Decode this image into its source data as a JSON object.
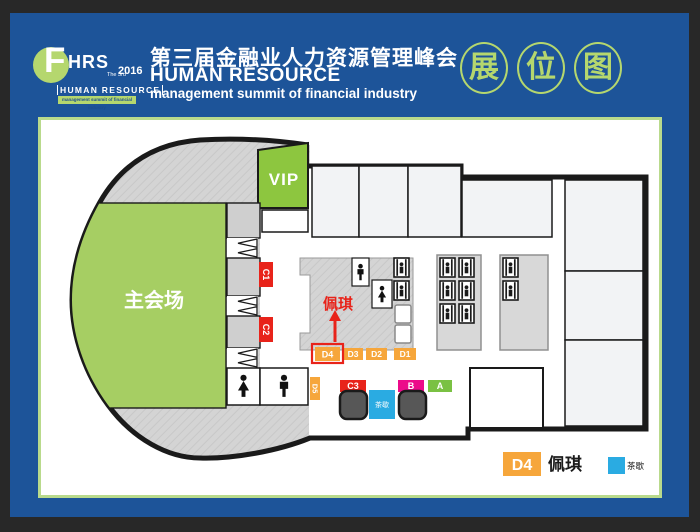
{
  "header": {
    "logo": {
      "f": "F",
      "brand": "HRS",
      "edition": "The 3rd",
      "year": "2016",
      "line1": "HUMAN RESOURCE",
      "line2": "management summit of financial industry"
    },
    "title_cn": "第三届金融业人力资源管理峰会",
    "title_en": "HUMAN RESOURCE",
    "title_sub": "management summit of financial industry",
    "badge": [
      "展",
      "位",
      "图"
    ]
  },
  "map": {
    "main_hall": "主会场",
    "vip": "VIP",
    "booths": {
      "c1": "C1",
      "c2": "C2",
      "c3": "C3",
      "d1": "D1",
      "d2": "D2",
      "d3": "D3",
      "d4": "D4",
      "d5": "D5",
      "b": "B",
      "a": "A"
    },
    "tea_break": "茶歇",
    "highlight_name": "佩琪"
  },
  "legend": {
    "booth_label": "D4",
    "booth_name": "佩琪",
    "tea_label": "茶歇"
  },
  "colors": {
    "background": "#1d5499",
    "accent_green": "#b5d76e",
    "vip_green": "#8dc63f",
    "hall_green": "#a6ce63",
    "booth_orange": "#f6a63b",
    "booth_red": "#e8231a",
    "booth_magenta": "#ec0b8a",
    "booth_green": "#7ac143",
    "tea_blue": "#2aabe2",
    "highlight_red": "#e8231a"
  }
}
